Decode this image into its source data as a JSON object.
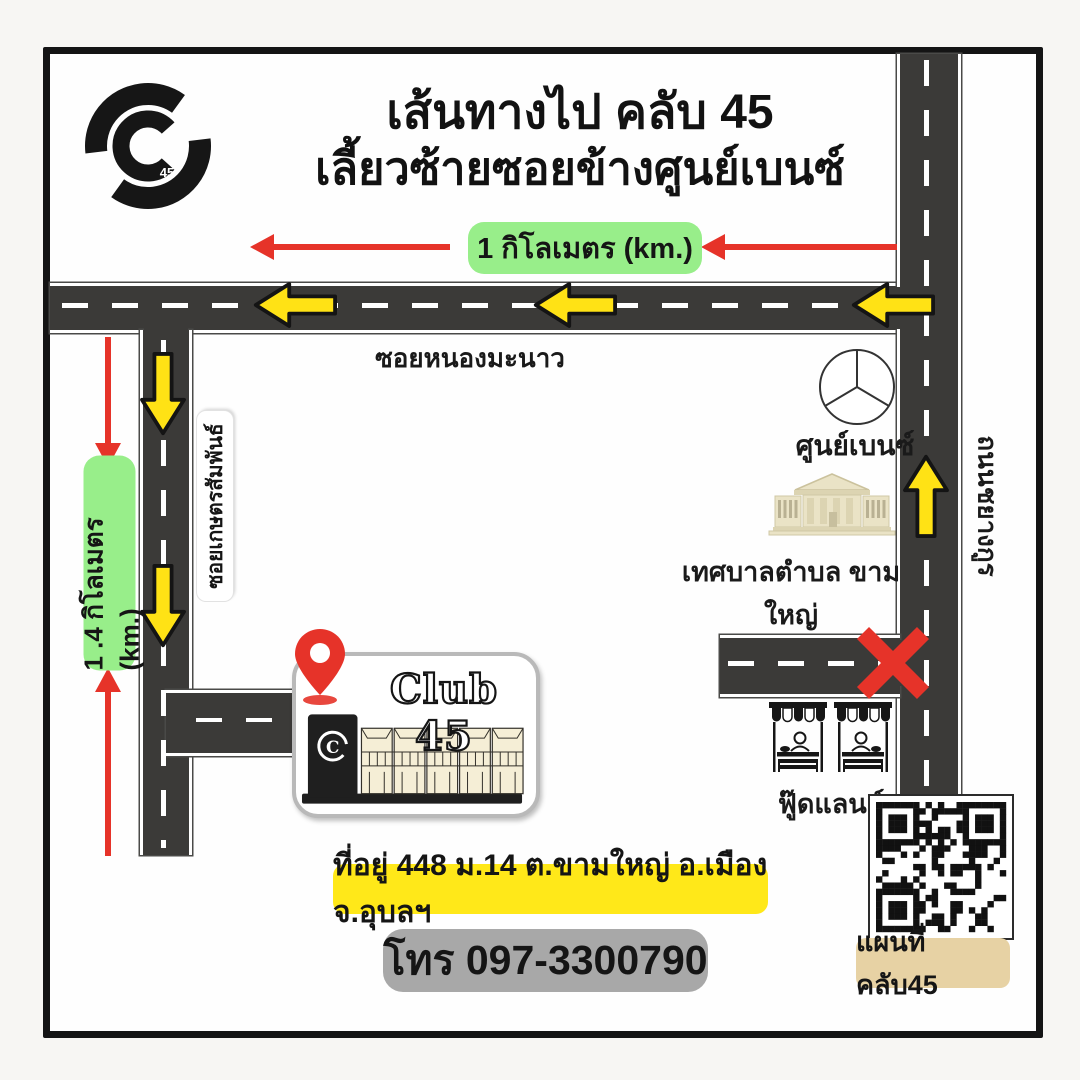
{
  "title": {
    "line1": "เส้นทางไป คลับ 45",
    "line2": "เลี้ยวซ้ายซอยข้างศูนย์เบนซ์"
  },
  "distance_labels": {
    "top": "1 กิโลเมตร (km.)",
    "left": "1 .4 กิโลเมตร (km.)"
  },
  "roads": {
    "horizontal": "ซอยหนองมะนาว",
    "left_vertical": "ซอยเกษตรสัมพันธ์",
    "right_vertical": "ถนนชยางกูร"
  },
  "places": {
    "benz": "ศูนย์เบนซ์",
    "municipality": "เทศบาลตำบล ขามใหญ่",
    "foodland": "ฟู๊ดแลนด์",
    "club": "Club 45",
    "logo_number": "45",
    "club_logo_letter": "C"
  },
  "footer": {
    "address": "ที่อยู่ 448 ม.14 ต.ขามใหญ่ อ.เมือง จ.อุบลฯ",
    "phone": "โทร 097-3300790",
    "qr_caption": "แผนที่ คลับ45"
  },
  "colors": {
    "road": "#3b3a38",
    "arrow_yellow": "#ffe215",
    "red": "#e63329",
    "green_label": "#98ee8a",
    "yellow_label": "#ffe819",
    "gray_label": "#a8a8a8",
    "tan_label": "#e7d2a4",
    "building_cream": "#eae3c6"
  }
}
